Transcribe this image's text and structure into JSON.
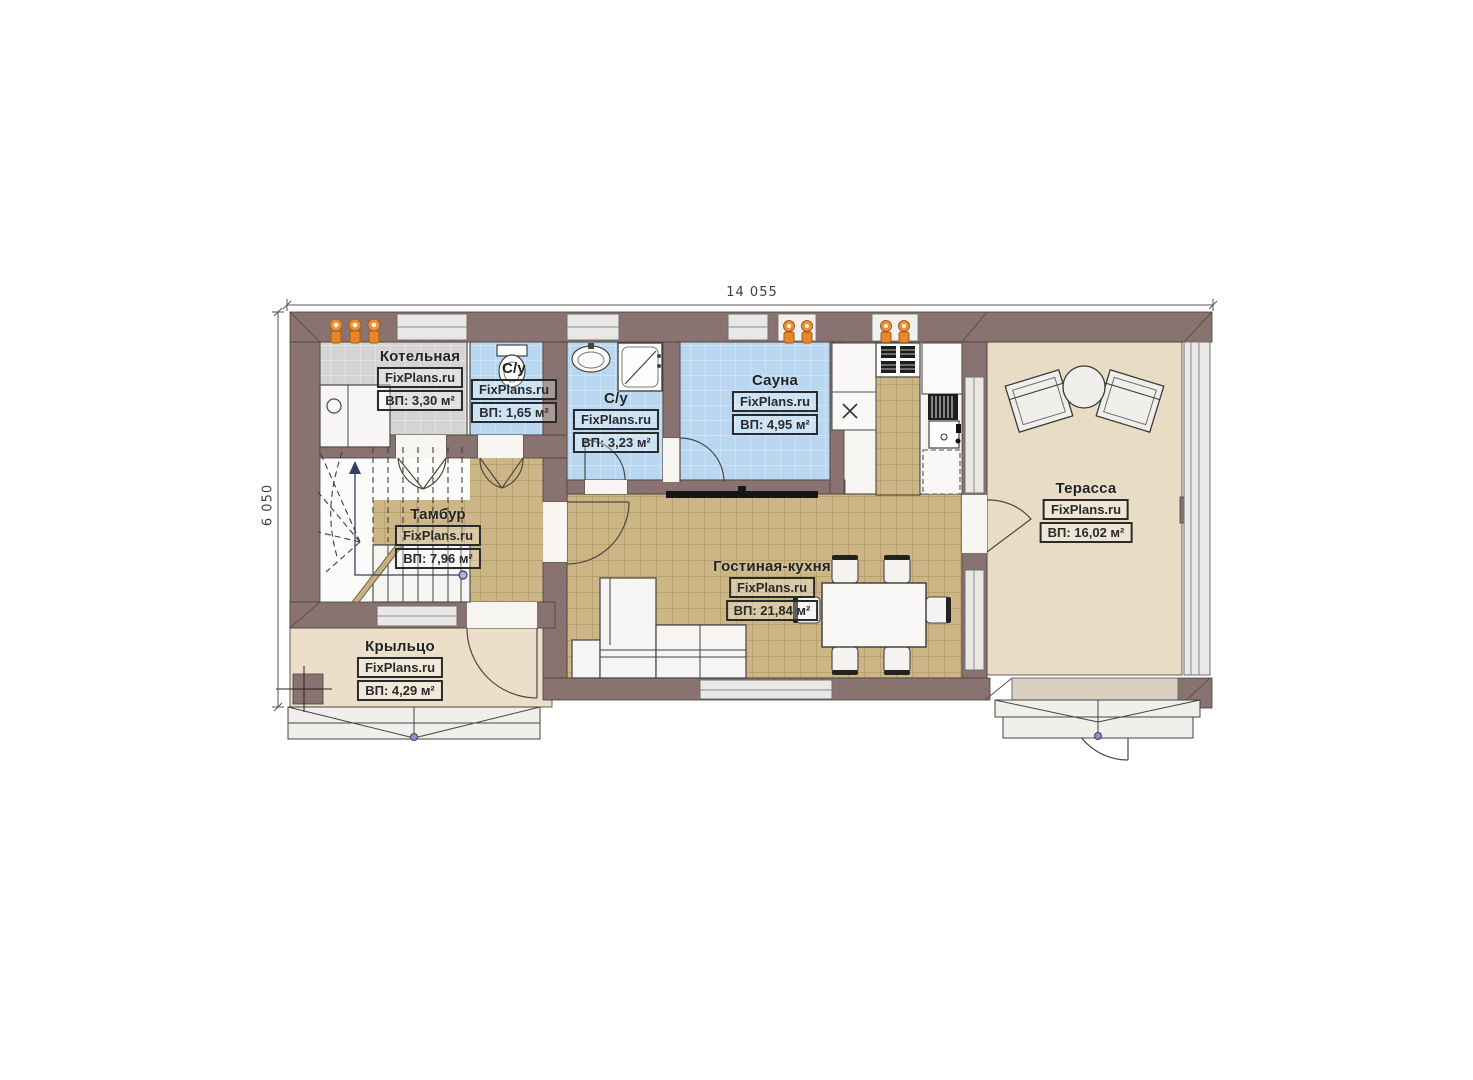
{
  "watermark": "FixPlans.ru",
  "dimensions": {
    "width": "14 055",
    "height": "6 050"
  },
  "rooms": [
    {
      "key": "boiler-room",
      "name": "Котельная",
      "area": "ВП: 3,30 м²"
    },
    {
      "key": "bathroom-1",
      "name": "С/у",
      "area": "ВП: 1,65 м²"
    },
    {
      "key": "bathroom-2",
      "name": "С/у",
      "area": "ВП: 3,23 м²"
    },
    {
      "key": "sauna",
      "name": "Сауна",
      "area": "ВП: 4,95 м²"
    },
    {
      "key": "vestibule",
      "name": "Тамбур",
      "area": "ВП: 7,96 м²"
    },
    {
      "key": "living-kitchen",
      "name": "Гостиная-кухня",
      "area": "ВП: 21,84 м²"
    },
    {
      "key": "terrace",
      "name": "Терасса",
      "area": "ВП: 16,02 м²"
    },
    {
      "key": "porch",
      "name": "Крыльцо",
      "area": "ВП: 4,29 м²"
    }
  ],
  "colors": {
    "wall": "#897370",
    "tile_tan": "#cdb685",
    "tile_blue": "#b9d7f1",
    "tile_gray": "#d4d4d4",
    "terrace_floor": "#e8dcc5",
    "porch_floor": "#ebdfc9",
    "equipment_orange": "#e8862b"
  }
}
